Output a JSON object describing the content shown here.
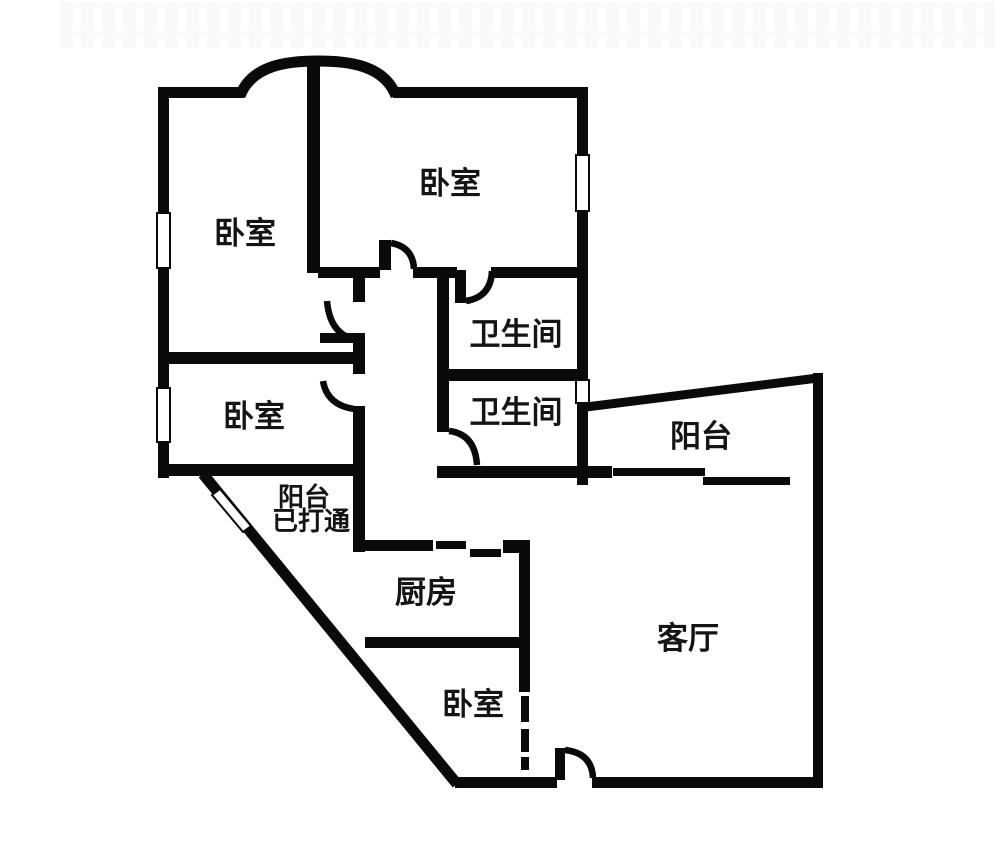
{
  "page": {
    "background_color": "#ffffff",
    "wall_color": "#0a0a0a",
    "text_color": "#141414"
  },
  "floor_plan": {
    "rooms": [
      {
        "id": "bedroom-top-left",
        "label": "卧室"
      },
      {
        "id": "bedroom-top-right",
        "label": "卧室"
      },
      {
        "id": "bathroom-upper",
        "label": "卫生间"
      },
      {
        "id": "bathroom-lower",
        "label": "卫生间"
      },
      {
        "id": "bedroom-mid-left",
        "label": "卧室"
      },
      {
        "id": "balcony-right",
        "label": "阳台"
      },
      {
        "id": "balcony-left",
        "label": "阳台",
        "sublabel": "已打通"
      },
      {
        "id": "kitchen",
        "label": "厨房"
      },
      {
        "id": "living-room",
        "label": "客厅"
      },
      {
        "id": "bedroom-bottom",
        "label": "卧室"
      }
    ]
  }
}
